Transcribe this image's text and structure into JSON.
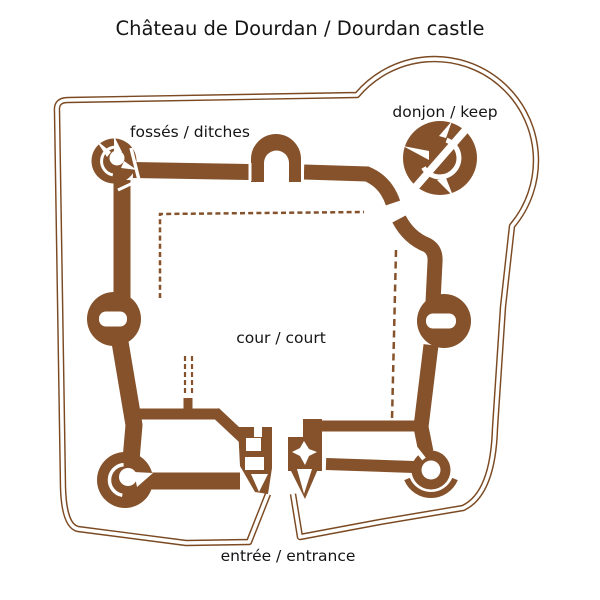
{
  "title": "Château de Dourdan / Dourdan castle",
  "map": {
    "labels": {
      "ditches": "fossés / ditches",
      "keep": "donjon / keep",
      "court": "cour / court",
      "entrance": "entrée / entrance"
    }
  },
  "colors": {
    "wall": "#85522B",
    "moat": "#7B4A23",
    "bg": "#FFFFFF",
    "text": "#151515"
  }
}
